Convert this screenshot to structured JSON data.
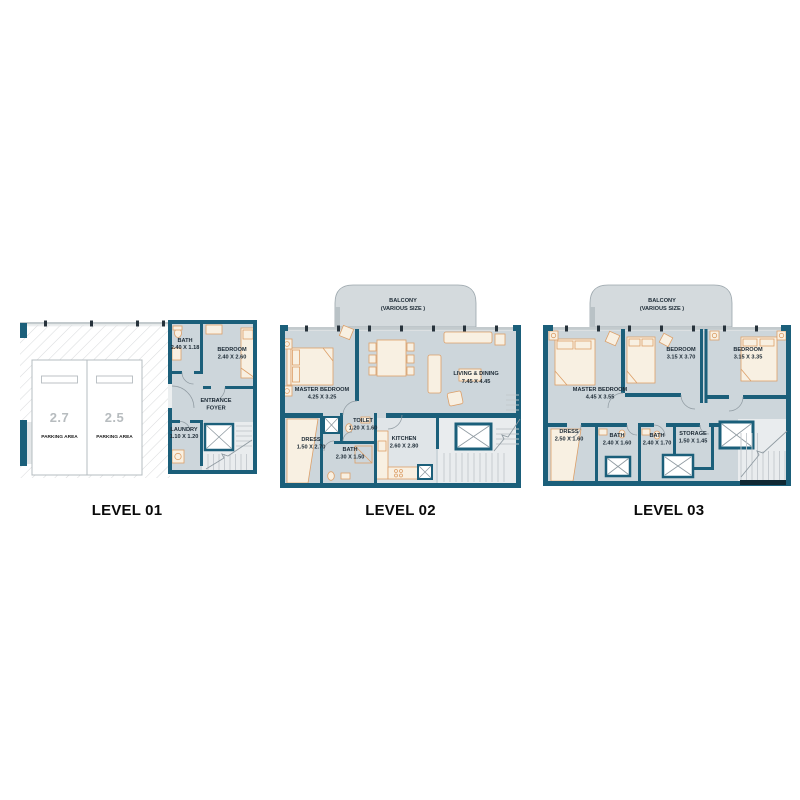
{
  "colors": {
    "wall": "#1b5f7a",
    "floor": "#cdd6db",
    "floor-light": "#e9ecee",
    "balcony": "#d4dadd",
    "balcony-border": "#9aa5ab",
    "furn-fill": "#f8f0e2",
    "furn-stroke": "#dc9f68",
    "label": "#1c2a35",
    "parking-number": "#b7bcbf",
    "hatch": "#d9dbdd",
    "window-band": "#c3cacd",
    "tick": "#27333c",
    "tread": "#c2c8cc",
    "door": "#8f9aa1",
    "outline-gray": "#b5bcc0",
    "title": "#0a0a0a"
  },
  "levels": {
    "level1": {
      "title": "LEVEL 01",
      "parking": [
        {
          "number": "2.7",
          "label": "PARKING AREA"
        },
        {
          "number": "2.5",
          "label": "PARKING AREA"
        }
      ],
      "rooms": {
        "bath": {
          "name": "BATH",
          "dims": "2.40 X 1.18"
        },
        "bedroom": {
          "name": "BEDROOM",
          "dims": "2.40 X 2.60"
        },
        "entrance_foyer": {
          "name_line1": "ENTRANCE",
          "name_line2": "FOYER"
        },
        "laundry": {
          "name": "LAUNDRY",
          "dims": "1.10 X 1.20"
        }
      }
    },
    "level2": {
      "title": "LEVEL 02",
      "rooms": {
        "balcony": {
          "name": "BALCONY",
          "dims": "(VARIOUS SIZE )"
        },
        "master_bedroom": {
          "name": "MASTER BEDROOM",
          "dims": "4.25 X 3.25"
        },
        "living_dining": {
          "name": "LIVING & DINING",
          "dims": "7.45 X 4.45"
        },
        "dress": {
          "name": "DRESS",
          "dims": "1.50 X 2.70"
        },
        "toilet": {
          "name": "TOILET",
          "dims": "1.20 X 1.60"
        },
        "bath": {
          "name": "BATH",
          "dims": "2.30 X 1.50"
        },
        "kitchen": {
          "name": "KITCHEN",
          "dims": "2.60 X 2.80"
        }
      }
    },
    "level3": {
      "title": "LEVEL 03",
      "rooms": {
        "balcony": {
          "name": "BALCONY",
          "dims": "(VARIOUS SIZE )"
        },
        "master_bedroom": {
          "name": "MASTER BEDROOM",
          "dims": "4.45 X 3.55"
        },
        "bedroom_1": {
          "name": "BEDROOM",
          "dims": "3.15 X 3.70"
        },
        "bedroom_2": {
          "name": "BEDROOM",
          "dims": "3.15 X 3.35"
        },
        "dress": {
          "name": "DRESS",
          "dims": "2.50 X 1.60"
        },
        "bath_1": {
          "name": "BATH",
          "dims": "2.40 X 1.60"
        },
        "bath_2": {
          "name": "BATH",
          "dims": "2.40 X 1.70"
        },
        "storage": {
          "name": "STORAGE",
          "dims": "1.50 X 1.45"
        }
      }
    }
  }
}
